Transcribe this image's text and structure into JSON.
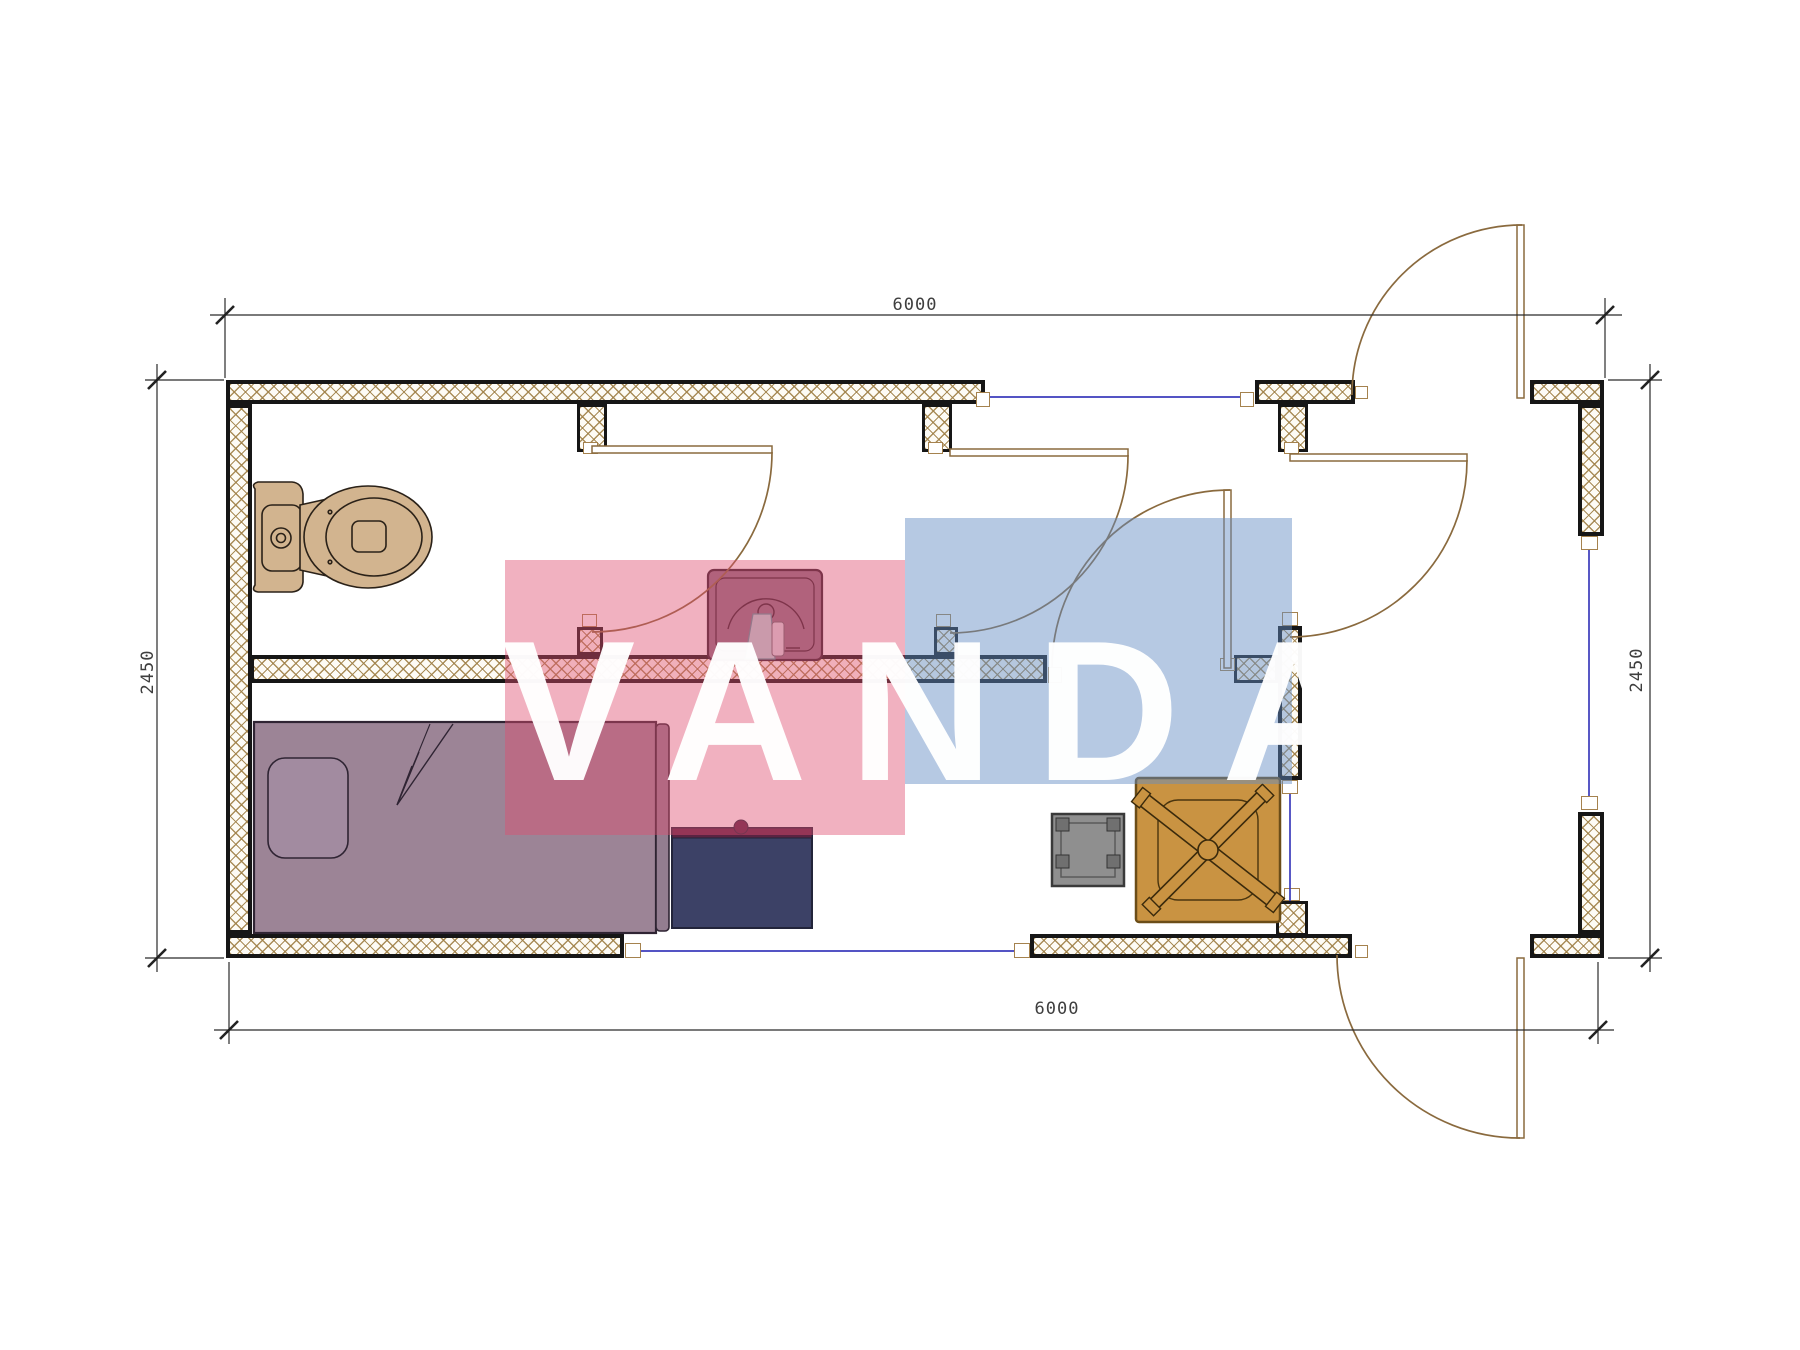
{
  "drawing": {
    "type": "floor-plan",
    "dimensions": {
      "top": "6000",
      "bottom": "6000",
      "left": "2450",
      "right": "2450"
    },
    "watermark": {
      "text": "VANDA",
      "pink": "#e04d70",
      "blue": "#648cc3"
    },
    "colors": {
      "wall_hatch": "#a08148",
      "wall_border": "#161616",
      "door_swing": "#8a6a3e",
      "window_line": "#3b3bbb",
      "toilet": "#d2b48f",
      "bed": "#9c8496",
      "pillow": "#a28ba0",
      "cabinet": "#3c4166",
      "cabinet_top": "#5a2342",
      "sink": "#8e7286",
      "towel": "#b9d7d9",
      "stool": "#8f8f8f",
      "table": "#c99342",
      "dim_text": "#3e3e3e"
    },
    "rooms": {
      "furniture": [
        "toilet",
        "bed",
        "nightstand-cabinet",
        "sink",
        "stool",
        "table-with-fan"
      ]
    }
  }
}
